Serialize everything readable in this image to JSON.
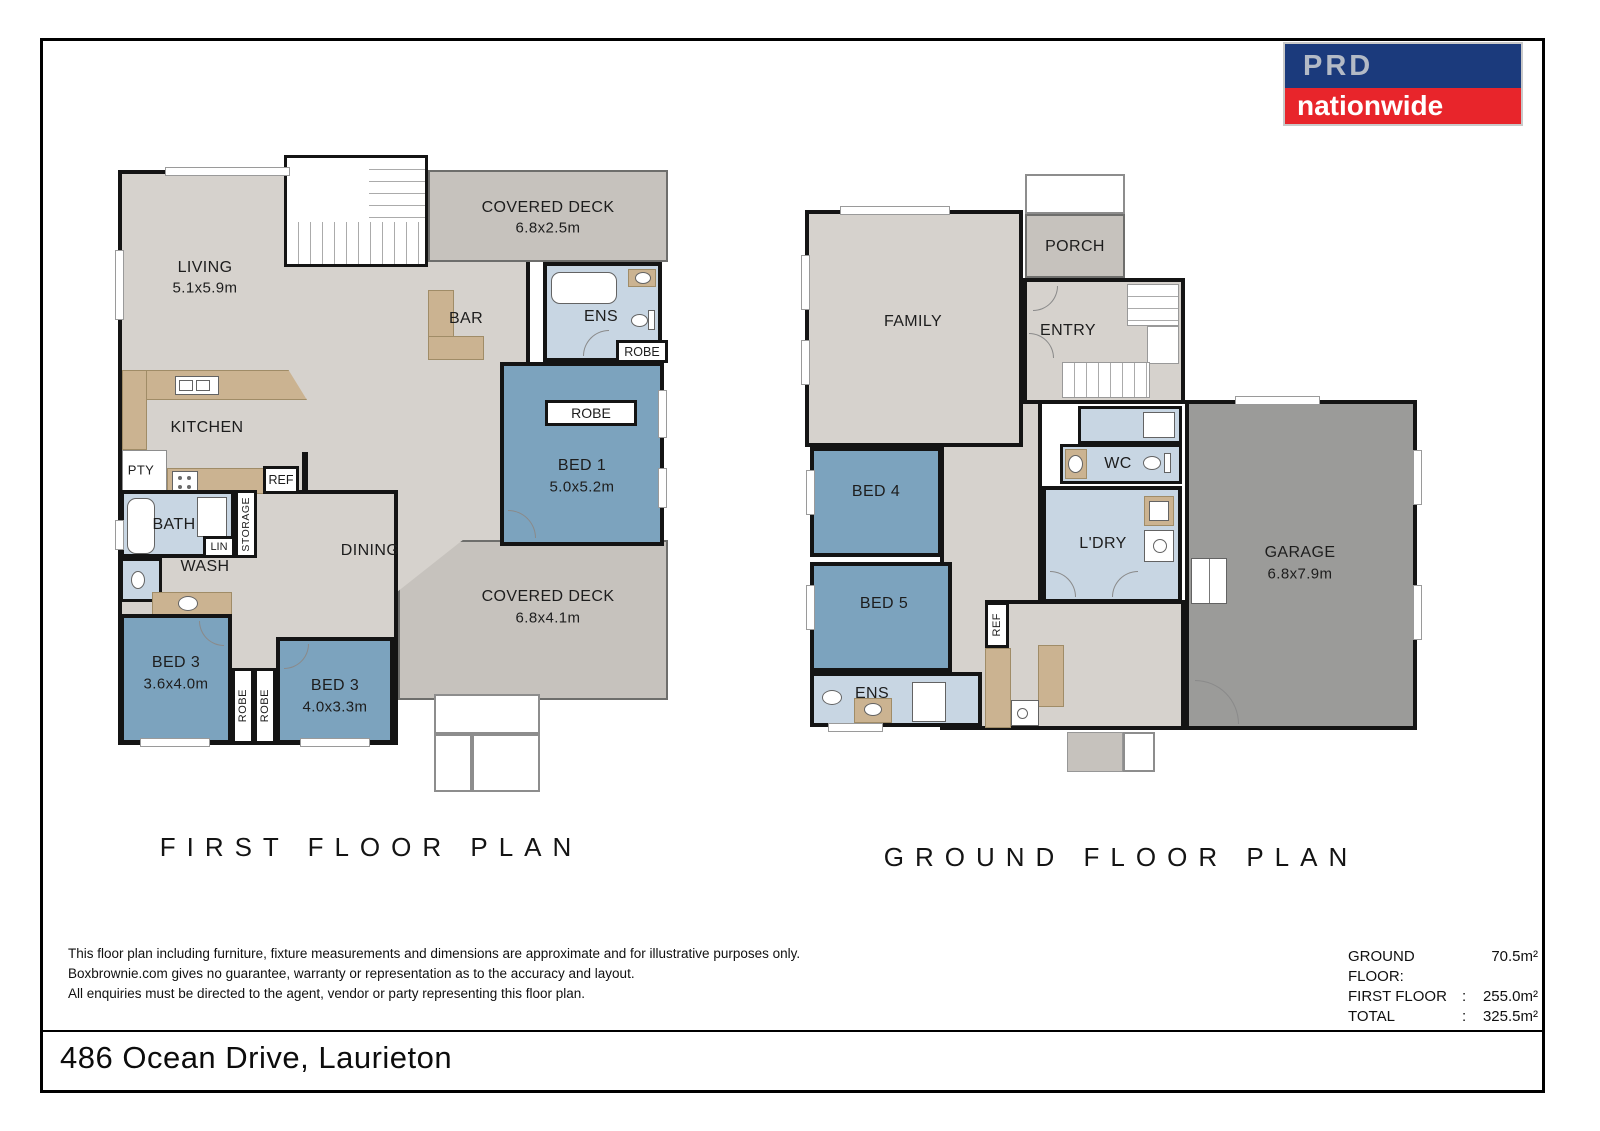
{
  "logo": {
    "top": "PRD",
    "bottom": "nationwide",
    "navy": "#1b3a7c",
    "red": "#e8252b"
  },
  "colors": {
    "floor_gray": "#d6d2cd",
    "deck_gray": "#c6c2bd",
    "garage_gray": "#9b9b99",
    "bedroom_blue": "#7ca3be",
    "wet_area_blue": "#c8d6e3",
    "counter_tan": "#cbb391",
    "wall_black": "#141414"
  },
  "first_floor": {
    "title": "FIRST FLOOR PLAN",
    "labels": {
      "living": {
        "name": "LIVING",
        "dims": "5.1x5.9m"
      },
      "deck_top": {
        "name": "COVERED DECK",
        "dims": "6.8x2.5m"
      },
      "bar": "BAR",
      "ens": "ENS",
      "robe_ens": "ROBE",
      "bed1": {
        "name": "BED 1",
        "dims": "5.0x5.2m"
      },
      "robe_bed1": "ROBE",
      "kitchen": "KITCHEN",
      "pty": "PTY",
      "ref": "REF",
      "bath": "BATH",
      "storage": "STORAGE",
      "lin": "LIN",
      "wash": "WASH",
      "dining": "DINING",
      "bed3a": {
        "name": "BED 3",
        "dims": "3.6x4.0m"
      },
      "robe_a": "ROBE",
      "robe_b": "ROBE",
      "bed3b": {
        "name": "BED 3",
        "dims": "4.0x3.3m"
      },
      "deck_bottom": {
        "name": "COVERED DECK",
        "dims": "6.8x4.1m"
      }
    }
  },
  "ground_floor": {
    "title": "GROUND FLOOR PLAN",
    "labels": {
      "family": "FAMILY",
      "porch": "PORCH",
      "entry": "ENTRY",
      "wc": "WC",
      "bed4": "BED 4",
      "ldry": "L'DRY",
      "garage": {
        "name": "GARAGE",
        "dims": "6.8x7.9m"
      },
      "bed5": "BED 5",
      "ref": "REF",
      "ens": "ENS"
    }
  },
  "footer": {
    "disclaimer": [
      "This floor plan including furniture, fixture measurements and dimensions are approximate and for illustrative purposes only.",
      "Boxbrownie.com gives no guarantee, warranty or representation as to the accuracy and layout.",
      "All enquiries must be directed to the agent, vendor or party representing this floor plan."
    ],
    "areas": [
      {
        "label": "GROUND FLOOR:",
        "sep": "",
        "value": "70.5m²"
      },
      {
        "label": "FIRST FLOOR",
        "sep": ":",
        "value": "255.0m²"
      },
      {
        "label": "TOTAL",
        "sep": ":",
        "value": "325.5m²"
      }
    ],
    "address": "486 Ocean Drive, Laurieton"
  }
}
